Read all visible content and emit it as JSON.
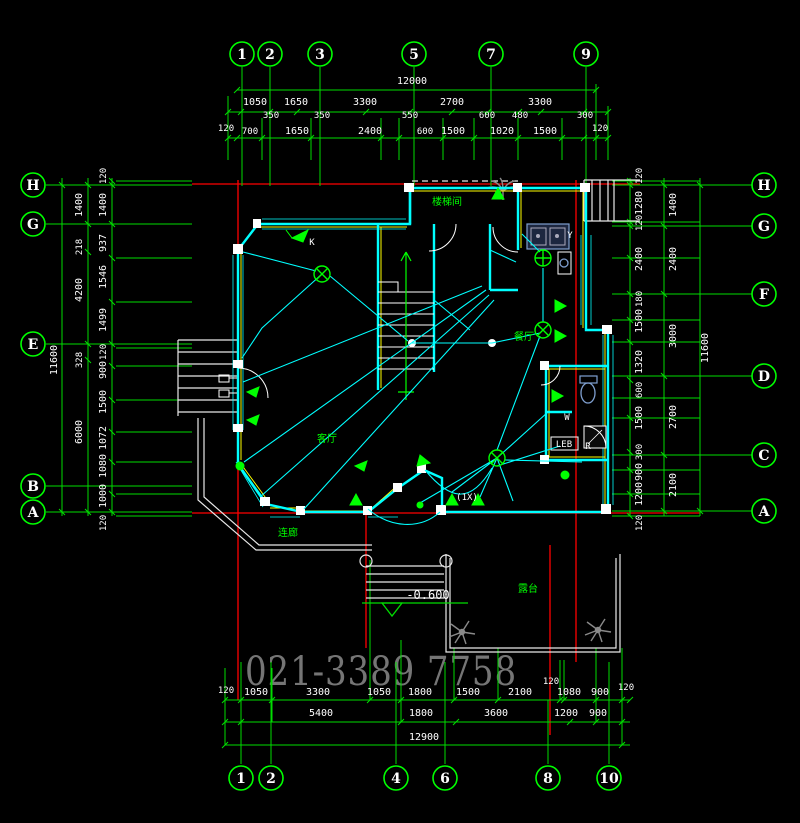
{
  "watermark": "021-3389 7758",
  "grid_bubbles": {
    "top": [
      "1",
      "2",
      "3",
      "5",
      "7",
      "9"
    ],
    "bottom": [
      "1",
      "2",
      "4",
      "6",
      "8",
      "10"
    ],
    "left": [
      "H",
      "G",
      "E",
      "B",
      "A"
    ],
    "right": [
      "H",
      "G",
      "F",
      "D",
      "C",
      "A"
    ]
  },
  "dimensions": {
    "top": {
      "total": "12000",
      "row2": [
        "1050",
        "1650",
        "3300",
        "2700",
        "3300"
      ],
      "row2_minor": [
        "350",
        "350",
        "550",
        "600",
        "480",
        "300"
      ],
      "row3": [
        "120",
        "700",
        "1650",
        "2400",
        "600",
        "1500",
        "1020",
        "1500",
        "120"
      ]
    },
    "bottom": {
      "row1": [
        "120",
        "1050",
        "3300",
        "1050",
        "1800",
        "1500",
        "2100",
        "1080",
        "900",
        "120"
      ],
      "row1_minor": "120",
      "row2": [
        "5400",
        "1800",
        "3600",
        "1200",
        "900"
      ],
      "total": "12900"
    },
    "left": {
      "total": "11600",
      "middle": [
        "1400",
        "218",
        "4200",
        "328",
        "6000"
      ],
      "inner": [
        "120",
        "1400",
        "937",
        "1546",
        "1499",
        "120",
        "900",
        "1500",
        "1072",
        "1080",
        "1000",
        "120"
      ]
    },
    "right": {
      "total": "11600",
      "middle": [
        "1400",
        "2400",
        "3000",
        "2700",
        "2100"
      ],
      "inner": [
        "120",
        "1280",
        "120",
        "2400",
        "180",
        "1500",
        "1320",
        "600",
        "1500",
        "300",
        "900",
        "1200",
        "120"
      ]
    }
  },
  "rooms": {
    "stair_hall": "楼梯间",
    "dining": "餐厅",
    "living": "客厅",
    "porch": "连廊",
    "terrace": "露台"
  },
  "annotations": {
    "level": "-0.600",
    "switch_k": "K",
    "label_y": "Y",
    "label_w": "W",
    "label_r": "R",
    "label_1x": "(1X)",
    "label_leb": "LEB"
  },
  "colors": {
    "background": "#000000",
    "dimension_green": "#00dd00",
    "bright_green": "#00ff00",
    "wall_cyan": "#00ffff",
    "accent_yellow": "#ffff00",
    "grid_red": "#ff0000",
    "text_white": "#ffffff",
    "watermark_gray": "#757575",
    "fixture_blue": "#7f9fd0"
  }
}
